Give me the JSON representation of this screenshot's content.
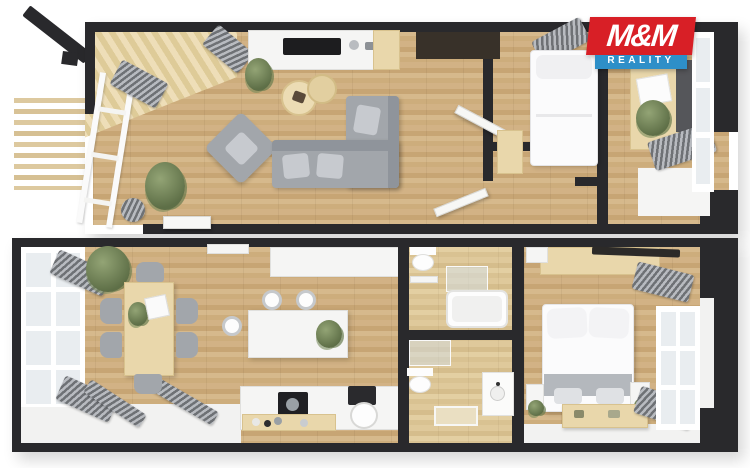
{
  "branding": {
    "logo_line1": "M&M",
    "logo_line2": "REALITY",
    "logo_primary_bg": "#d81f26",
    "logo_secondary_bg": "#2e8fc8",
    "logo_text_color": "#ffffff"
  },
  "palette": {
    "background": "#ffffff",
    "walls": "#29292c",
    "wood_floor": "#ccab7d",
    "bathroom_floor": "#dcc697",
    "terrace_deck": "#e6d5ae",
    "white_fixtures": "#f5f5f4",
    "gray_furniture": "#a2a6ab",
    "radiator_gray": "#8d9196",
    "plant_green": "#5e6f47"
  }
}
